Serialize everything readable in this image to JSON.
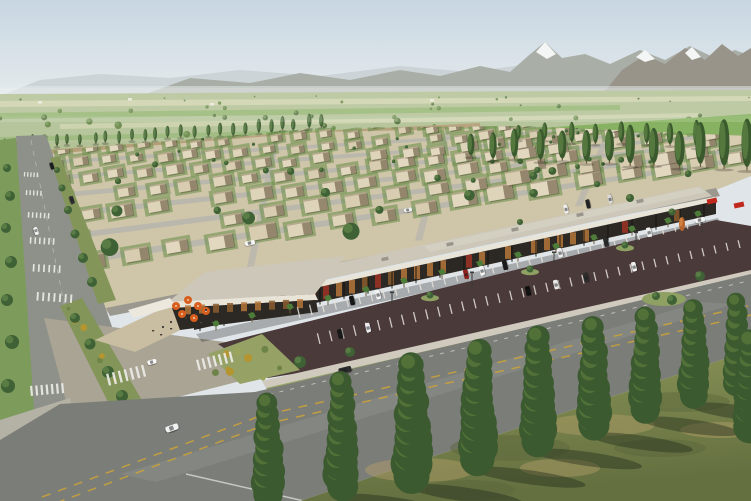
{
  "meta": {
    "alt": "Aerial rendering of a master-planned desert community: retail strip with parking, rows of flat-roofed houses, tree-lined boulevard, farm fields and mountains",
    "width": 751,
    "height": 501
  },
  "scene": {
    "sky": {
      "top": "#c7d6e2",
      "bottom": "#e9edee"
    },
    "mountains": {
      "far": "#c9d0d3",
      "main": "#a9aea6",
      "right": "#99948a",
      "snow": "#f4f6f5",
      "haze": "#e6ebec"
    },
    "fields": {
      "base": "#b3c296",
      "strip_light": "#cfd4ae",
      "strip_green": "#8db36a",
      "bright": "#7fae58",
      "tree_dark": "#55713f",
      "tree_light": "#7fa05f",
      "structure": "#eceade"
    },
    "development": {
      "ground": "#cfc5a9",
      "dirt": "#b59974",
      "lawn": "#6f9150",
      "street": "#b8b5ac",
      "house_light": "#ded4ba",
      "house_mid": "#d8cdb0",
      "house_warm": "#e2d8c0",
      "house_side": "#7e6e56",
      "house_parapet": "#b7a98e",
      "tree_dark": "#3f6136",
      "tree_light": "#5e8147"
    },
    "poplar": {
      "dark": "#3a5a2e",
      "light": "#5d7f44"
    },
    "roads": {
      "boulevard": "#8e908a",
      "back": "#9a988f",
      "main": "#7b7d78",
      "worn": "#b9bab2",
      "verge": "#7d9c5c",
      "median_green": "#84955a",
      "yellow": "#c9a23a",
      "white_line": "#dadad4",
      "crosswalk": "#ebebe6",
      "sidewalk": "#cfcabd",
      "corner_sidewalk": "#b4b1a5",
      "connector": "#a9a494"
    },
    "mall": {
      "roof": "#ccc7b9",
      "roof_light": "#d9d5c8",
      "fascia": "#e9e4d8",
      "storefront": "#2c2824",
      "window_warm": "#b5763a",
      "window_deep": "#8a5a2e",
      "window_red": "#a03326",
      "post": "#15130f",
      "unit": "#9a968b",
      "palm": "#4e7c3a",
      "trunk": "#6b5a3e",
      "canopy_white": "#ece8dd",
      "sign_red": "#c0271d",
      "shadow": "rgba(0,0,0,0.25)"
    },
    "patio": {
      "floor": "#c9bda2",
      "umbrella": "#d95f1e",
      "umbrella_tip": "#f8e8d8",
      "furniture": "#46403a",
      "person": "#3a3a3a"
    },
    "parking": {
      "asphalt": "#4a3a39",
      "stripe": "#e6e2da",
      "island": "#8fa063",
      "pole": "#3a3a38"
    },
    "landscape": {
      "strip": "#96a165",
      "shrub1": "#6d8348",
      "shrub2": "#9aa45c",
      "shrub3": "#b5952f"
    },
    "foreground": {
      "grass_light": "#8d9659",
      "grass_dark": "#647040",
      "dry": "#b5a06b",
      "patch_dark": "#5a673c",
      "tree_dark": "#3c5a2f",
      "tree_light": "#587a3c",
      "trunk": "#7a6a4c",
      "shadow": "rgba(32,42,26,0.42)",
      "accent_orange": "#b5652f",
      "accent_orange_light": "#d08040"
    }
  },
  "objects": {
    "counts": {
      "farm_trees": 48,
      "res_trees": 62,
      "landscape_shrubs": 16,
      "corner_shrubs": 9,
      "median_shrubs": 12
    },
    "poplar_rows": [
      {
        "x1": 6,
        "y1": 150,
        "x2": 320,
        "y2": 129,
        "n": 26,
        "h1": 11,
        "h2": 13,
        "w1": 3.5,
        "w2": 4.5
      },
      {
        "x1": 470,
        "y1": 158,
        "x2": 748,
        "y2": 170,
        "n": 13,
        "h1": 24,
        "h2": 44,
        "w1": 7,
        "w2": 11
      },
      {
        "x1": 520,
        "y1": 140,
        "x2": 748,
        "y2": 150,
        "n": 10,
        "h1": 16,
        "h2": 26,
        "w1": 5,
        "w2": 7
      }
    ],
    "verge_trees": [
      [
        7,
        168,
        4
      ],
      [
        10,
        196,
        5
      ],
      [
        6,
        228,
        5
      ],
      [
        11,
        262,
        6
      ],
      [
        7,
        300,
        6
      ],
      [
        12,
        342,
        7
      ],
      [
        8,
        386,
        7
      ]
    ],
    "median_upper_trees": [
      [
        57,
        170,
        3
      ],
      [
        62,
        188,
        3.5
      ],
      [
        68,
        210,
        4
      ],
      [
        75,
        234,
        4.5
      ],
      [
        83,
        258,
        5
      ],
      [
        92,
        282,
        5
      ]
    ],
    "median_trees": [
      [
        75,
        318,
        5
      ],
      [
        90,
        344,
        5.5
      ],
      [
        108,
        372,
        6
      ],
      [
        122,
        396,
        6
      ]
    ],
    "streets": {
      "y": [
        256,
        231,
        209,
        190,
        173,
        158
      ],
      "h": [
        7,
        6,
        5.5,
        5,
        4.5,
        4
      ]
    },
    "house_rows": [
      {
        "y": 268,
        "w": 23,
        "h": 13,
        "s": 40
      },
      {
        "y": 243,
        "w": 21,
        "h": 12,
        "s": 37
      },
      {
        "y": 220,
        "w": 19,
        "h": 11,
        "s": 34
      },
      {
        "y": 199,
        "w": 17,
        "h": 10,
        "s": 31
      },
      {
        "y": 181,
        "w": 15,
        "h": 9,
        "s": 29
      },
      {
        "y": 165,
        "w": 13,
        "h": 8,
        "s": 27
      },
      {
        "y": 151,
        "w": 11,
        "h": 7,
        "s": 25
      },
      {
        "y": 139,
        "w": 10,
        "h": 6,
        "s": 23
      }
    ],
    "cross_streets": [
      260,
      430,
      590
    ],
    "palms": [
      216,
      252,
      290,
      328,
      366,
      404,
      442,
      480,
      518,
      556,
      594,
      632,
      668,
      698
    ],
    "roof_units": [
      260,
      320,
      385,
      450,
      515,
      580,
      640
    ],
    "umbrellas": [
      [
        176,
        306
      ],
      [
        188,
        300
      ],
      [
        198,
        306
      ],
      [
        182,
        314
      ],
      [
        194,
        318
      ],
      [
        206,
        311
      ]
    ],
    "furniture": [
      [
        152,
        330
      ],
      [
        160,
        334
      ],
      [
        170,
        328
      ],
      [
        200,
        322
      ]
    ],
    "people": [
      [
        163,
        327
      ],
      [
        171,
        322
      ],
      [
        186,
        318
      ],
      [
        196,
        314
      ],
      [
        206,
        310
      ]
    ],
    "parking_rows": {
      "A": {
        "x1": 300,
        "y1": 318,
        "x2": 700,
        "y2": 226,
        "n": 34
      },
      "B": {
        "x1": 320,
        "y1": 344,
        "x2": 740,
        "y2": 248,
        "n": 36
      }
    },
    "parked_cars": [
      {
        "row": "A",
        "x": 352,
        "c": "#141414"
      },
      {
        "row": "A",
        "x": 378,
        "c": "#f2f2f2"
      },
      {
        "row": "A",
        "x": 466,
        "c": "#8f1f1c"
      },
      {
        "row": "A",
        "x": 482,
        "c": "#f4f4f4"
      },
      {
        "row": "A",
        "x": 505,
        "c": "#1a1a1a"
      },
      {
        "row": "A",
        "x": 560,
        "c": "#ececec"
      },
      {
        "row": "A",
        "x": 606,
        "c": "#2c2c2c"
      },
      {
        "row": "A",
        "x": 649,
        "c": "#efefef"
      },
      {
        "row": "B",
        "x": 340,
        "c": "#181818"
      },
      {
        "row": "B",
        "x": 368,
        "c": "#ededed"
      },
      {
        "row": "B",
        "x": 528,
        "c": "#0f0f0f"
      },
      {
        "row": "B",
        "x": 556,
        "c": "#e9e9e9"
      },
      {
        "row": "B",
        "x": 586,
        "c": "#2d2d2d"
      },
      {
        "row": "B",
        "x": 634,
        "c": "#f1f1f1"
      }
    ],
    "cars": [
      {
        "x": 52,
        "y": 166,
        "w": 7,
        "h": 3.5,
        "r": 72,
        "c": "#1c1c1e"
      },
      {
        "x": 72,
        "y": 200,
        "w": 8,
        "h": 4,
        "r": 72,
        "c": "#2e2e30"
      },
      {
        "x": 36,
        "y": 231,
        "w": 8,
        "h": 4,
        "r": 72,
        "c": "#f0f0ee"
      },
      {
        "x": 250,
        "y": 243,
        "w": 10,
        "h": 4.5,
        "r": -12,
        "c": "#f5f5f3"
      },
      {
        "x": 408,
        "y": 210,
        "w": 8,
        "h": 4,
        "r": -11,
        "c": "#eeeeec"
      },
      {
        "x": 566,
        "y": 209,
        "w": 9,
        "h": 4,
        "r": -103,
        "c": "#ededeb"
      },
      {
        "x": 588,
        "y": 204,
        "w": 9,
        "h": 4,
        "r": -103,
        "c": "#242424"
      },
      {
        "x": 610,
        "y": 199,
        "w": 9,
        "h": 4,
        "r": -103,
        "c": "#d9d9d7"
      },
      {
        "x": 700,
        "y": 220,
        "w": 10,
        "h": 4.5,
        "r": -12,
        "c": "#f4f4f2"
      },
      {
        "x": 345,
        "y": 370,
        "w": 13,
        "h": 6,
        "r": -14,
        "c": "#2b2b2e"
      },
      {
        "x": 548,
        "y": 412,
        "w": 12,
        "h": 6,
        "r": -17,
        "c": "#26262a"
      },
      {
        "x": 172,
        "y": 428,
        "w": 13,
        "h": 6,
        "r": -20,
        "c": "#f2f2f0"
      },
      {
        "x": 152,
        "y": 362,
        "w": 9,
        "h": 4.5,
        "r": -15,
        "c": "#fafafa"
      }
    ],
    "crosswalks_boulevard": [
      [
        24,
        172,
        3,
        5,
        3.2,
        1.3,
        4.5
      ],
      [
        26,
        190,
        3,
        5,
        3.6,
        1.4,
        5
      ],
      [
        28,
        212,
        3,
        6,
        4,
        1.5,
        5.5
      ],
      [
        30,
        237,
        3,
        6,
        4.6,
        1.6,
        6.5
      ],
      [
        33,
        264,
        3,
        6,
        5.2,
        1.7,
        7.5
      ],
      [
        37,
        292,
        4,
        7,
        5.6,
        1.9,
        8.5
      ]
    ],
    "crosswalks_road": [
      [
        30,
        386,
        -5,
        7,
        5.2,
        2.2,
        10
      ],
      [
        106,
        374,
        -14,
        7,
        6,
        2.4,
        12
      ],
      [
        196,
        360,
        -14,
        7,
        5.6,
        2.3,
        11
      ]
    ],
    "light_poles": [
      [
        392,
        306
      ],
      [
        472,
        286
      ],
      [
        554,
        266
      ],
      [
        636,
        246
      ],
      [
        702,
        232
      ]
    ],
    "dry_patches": [
      [
        420,
        470,
        55,
        12,
        "dry"
      ],
      [
        510,
        448,
        60,
        13,
        "dark"
      ],
      [
        600,
        425,
        55,
        11,
        "dry"
      ],
      [
        680,
        402,
        50,
        10,
        "dark"
      ],
      [
        470,
        490,
        45,
        10,
        "dark"
      ],
      [
        560,
        468,
        40,
        9,
        "dry"
      ],
      [
        660,
        448,
        46,
        9,
        "dark"
      ],
      [
        720,
        430,
        40,
        8,
        "dry"
      ]
    ],
    "fg_trees": [
      [
        268,
        503,
        105,
        36
      ],
      [
        342,
        495,
        118,
        38
      ],
      [
        412,
        485,
        125,
        44
      ],
      [
        478,
        468,
        122,
        42
      ],
      [
        538,
        450,
        118,
        40
      ],
      [
        594,
        434,
        112,
        38
      ],
      [
        646,
        418,
        106,
        36
      ],
      [
        694,
        404,
        100,
        34
      ],
      [
        737,
        392,
        95,
        32
      ],
      [
        751,
        436,
        100,
        40
      ]
    ],
    "landscape_trees": [
      [
        300,
        362,
        6
      ],
      [
        350,
        352,
        5
      ],
      [
        700,
        276,
        5
      ]
    ],
    "roundabout_trees": [
      [
        656,
        296,
        4
      ],
      [
        672,
        300,
        5
      ]
    ],
    "behind_mall_trees": [
      [
        630,
        198,
        4
      ],
      [
        672,
        212,
        3.5
      ],
      [
        520,
        222,
        3
      ]
    ],
    "red_signs": [
      [
        712,
        201
      ],
      [
        739,
        205
      ]
    ],
    "farm_structures": [
      [
        38,
        101
      ],
      [
        128,
        98
      ],
      [
        210,
        103
      ],
      [
        430,
        99
      ]
    ]
  }
}
